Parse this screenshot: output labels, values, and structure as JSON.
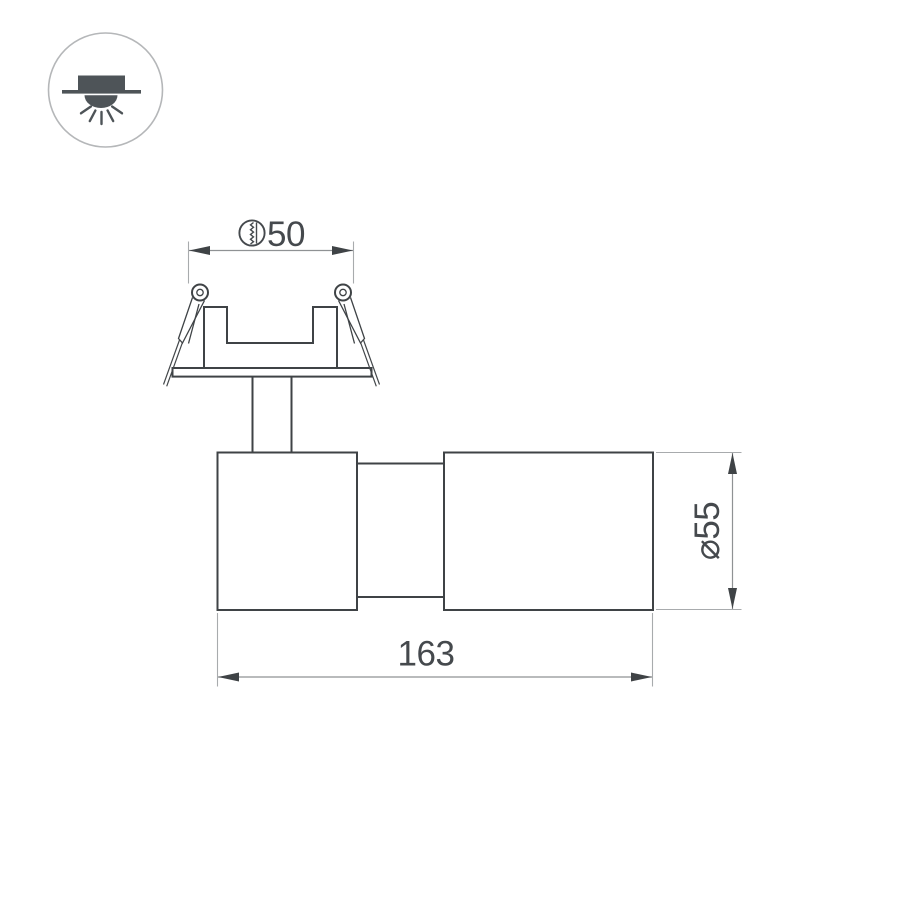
{
  "icons": {
    "corner_icon": "recessed-ceiling-downlight-icon",
    "cutout_symbol": "saw-cut-hole-icon"
  },
  "dimensions": {
    "cutout": {
      "value": "50",
      "symbol": "saw-cut-hole"
    },
    "diameter": {
      "value": "⌀55"
    },
    "length": {
      "value": "163"
    }
  },
  "colors": {
    "background": "#ffffff",
    "outline": "#3f4346",
    "dimension_line": "#8f9294",
    "extension_line": "#a8abad",
    "text": "#45494d",
    "icon_glyph": "#4e5458",
    "icon_ring": "#b5b7b9"
  }
}
